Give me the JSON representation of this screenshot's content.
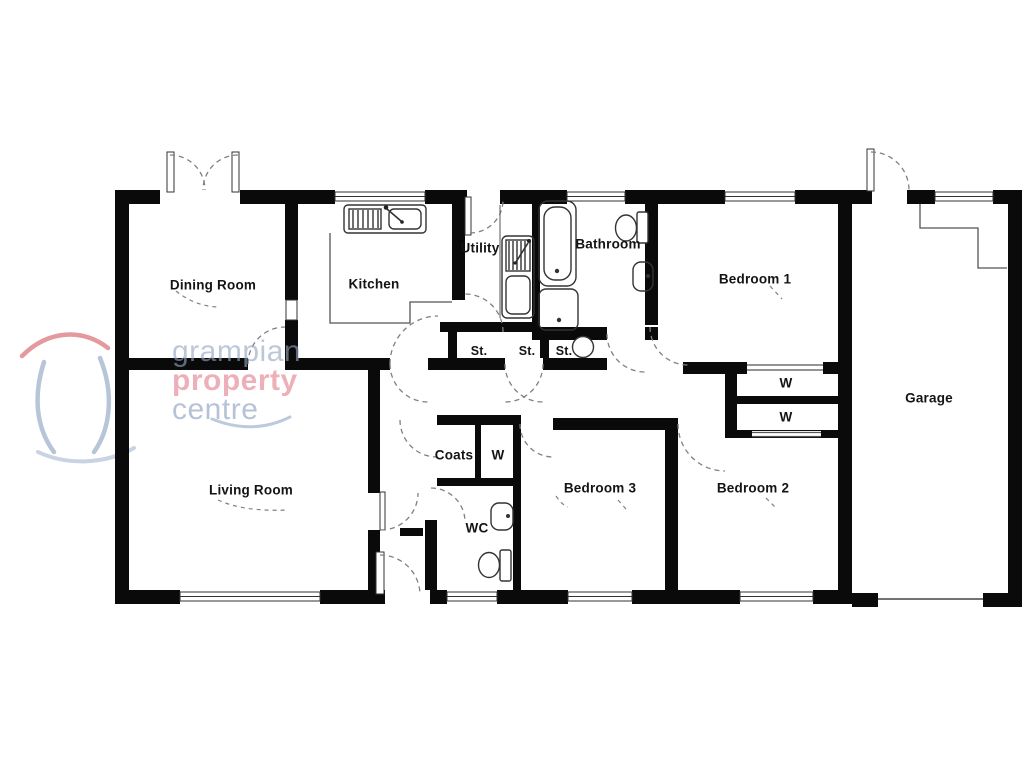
{
  "floorplan": {
    "rooms": [
      {
        "label": "Dining Room"
      },
      {
        "label": "Kitchen"
      },
      {
        "label": "Utility"
      },
      {
        "label": "Bathroom"
      },
      {
        "label": "Bedroom 1"
      },
      {
        "label": "Garage"
      },
      {
        "label": "Living Room"
      },
      {
        "label": "Bedroom 3"
      },
      {
        "label": "Bedroom 2"
      },
      {
        "label": "WC"
      },
      {
        "label": "Coats"
      }
    ],
    "storage": [
      {
        "label": "St."
      },
      {
        "label": "St."
      },
      {
        "label": "St."
      }
    ],
    "wardrobes": [
      {
        "label": "W"
      },
      {
        "label": "W"
      },
      {
        "label": "W"
      }
    ],
    "logo": {
      "word1": "grampian",
      "word2": "property",
      "word3": "centre"
    },
    "colors": {
      "wall": "#0a0a0a",
      "fixture_line": "#333333",
      "thin_line": "#555555",
      "door_arc": "#808080",
      "logo_blue": "#8ca4c4",
      "logo_red": "#e08090"
    }
  }
}
